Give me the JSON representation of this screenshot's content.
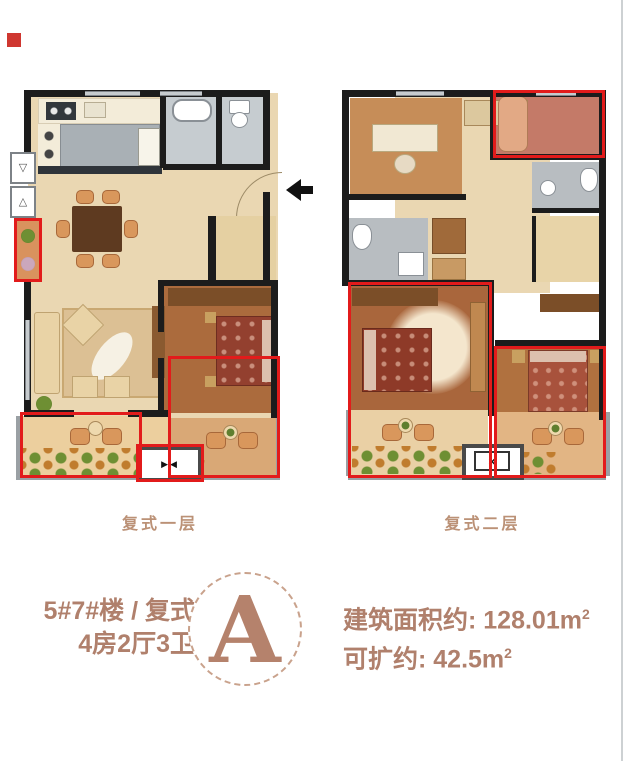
{
  "page": {
    "marker_color": "#cf3730",
    "accent_text_color": "#b0806c",
    "highlight_color": "#e21b1b"
  },
  "plans": [
    {
      "label": "复式一层"
    },
    {
      "label": "复式二层"
    }
  ],
  "icons": {
    "shaft_down": "▽",
    "shaft_up": "△",
    "elevator_doors": "▶◀",
    "elevator_cross": "×"
  },
  "info": {
    "building": "5#7#楼 / 复式",
    "rooms": "4房2厅3卫",
    "unit_letter": "A",
    "area_text": "建筑面积约: 128.01m",
    "area_sup": "2",
    "expand_text": "可扩约: 42.5m",
    "expand_sup": "2"
  }
}
